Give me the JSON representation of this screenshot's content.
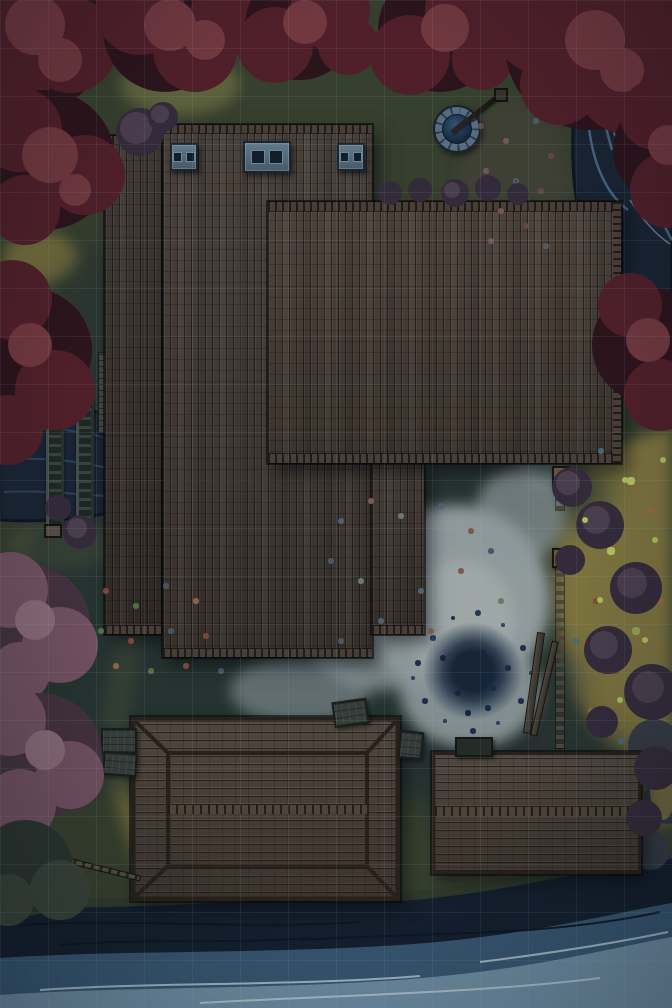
{
  "map": {
    "kind": "top-down fantasy battle map",
    "scene": "nighttime riverside inn with autumn trees, well, fenced meadow, two barns and a lakeshore",
    "grid": {
      "size_px": 48,
      "columns": 14,
      "rows": 21
    }
  },
  "palette": {
    "ground": "#3a432d",
    "moss": "#867b41",
    "meadow": "#8c7f42",
    "shadow": "#223033",
    "path_light": "#a3adad",
    "roof_annex": "#3b322a",
    "roof_main": "#463b31",
    "roof_east": "#4a3e33",
    "roof_store": "#40362d",
    "roof_barn": "#4c4034",
    "cap": "#4e4238",
    "wood_light": "#57483a",
    "tree_dark": "#2e1219",
    "tree_mid": "#561f28",
    "tree_light": "#7b3a40",
    "pink_dark": "#47333f",
    "pink_mid": "#7a5565",
    "pink_light": "#94707e",
    "bush_dark": "#372c3a",
    "bush_mid": "#4f4150",
    "water_dark": "#141f2d",
    "water_mid": "#3b5c77",
    "water_light": "#7e9fb2",
    "foam": "#c7d8e0",
    "river": "#1a2534",
    "river_streak": "#557a9c",
    "stone": "#5e7588",
    "stone_dark": "#141f29"
  },
  "features": [
    {
      "name": "main-hall-roof",
      "x": 163,
      "y": 125,
      "w": 209,
      "h": 532
    },
    {
      "name": "east-wing-roof",
      "x": 268,
      "y": 202,
      "w": 353,
      "h": 261
    },
    {
      "name": "west-annex-roof",
      "x": 105,
      "y": 136,
      "w": 56,
      "h": 498
    },
    {
      "name": "store-annex-roof",
      "x": 372,
      "y": 463,
      "w": 52,
      "h": 171
    },
    {
      "name": "chimney-small-west",
      "x": 170,
      "y": 143,
      "w": 24,
      "h": 24
    },
    {
      "name": "chimney-large-center",
      "x": 243,
      "y": 141,
      "w": 44,
      "h": 28
    },
    {
      "name": "chimney-small-east",
      "x": 337,
      "y": 143,
      "w": 24,
      "h": 24
    },
    {
      "name": "stone-well",
      "cx": 455,
      "cy": 127,
      "r": 22
    },
    {
      "name": "courtyard-stain",
      "cx": 472,
      "cy": 672,
      "r": 60
    },
    {
      "name": "picket-fence",
      "x": 556,
      "y": 468,
      "w": 8,
      "h": 280
    },
    {
      "name": "hip-roof-barn",
      "x": 131,
      "y": 717,
      "w": 269,
      "h": 184
    },
    {
      "name": "flat-roof-barn",
      "x": 432,
      "y": 752,
      "w": 203,
      "h": 116
    },
    {
      "name": "slipway-rails",
      "x": 46,
      "y": 396,
      "w": 42,
      "h": 136
    },
    {
      "name": "mill-platform",
      "x": 95,
      "y": 352,
      "w": 62,
      "h": 228
    },
    {
      "name": "west-river",
      "x": 0,
      "y": 402,
      "w": 114,
      "h": 120
    },
    {
      "name": "east-river",
      "x": 574,
      "y": 0,
      "w": 98,
      "h": 305
    },
    {
      "name": "lake-shore",
      "x": 0,
      "y": 856,
      "w": 672,
      "h": 152
    },
    {
      "name": "red-tree-canopies",
      "area": "top edge, left side, right middle"
    },
    {
      "name": "pink-trees",
      "area": "bottom left"
    },
    {
      "name": "yellow-meadow",
      "area": "right of fence"
    }
  ]
}
